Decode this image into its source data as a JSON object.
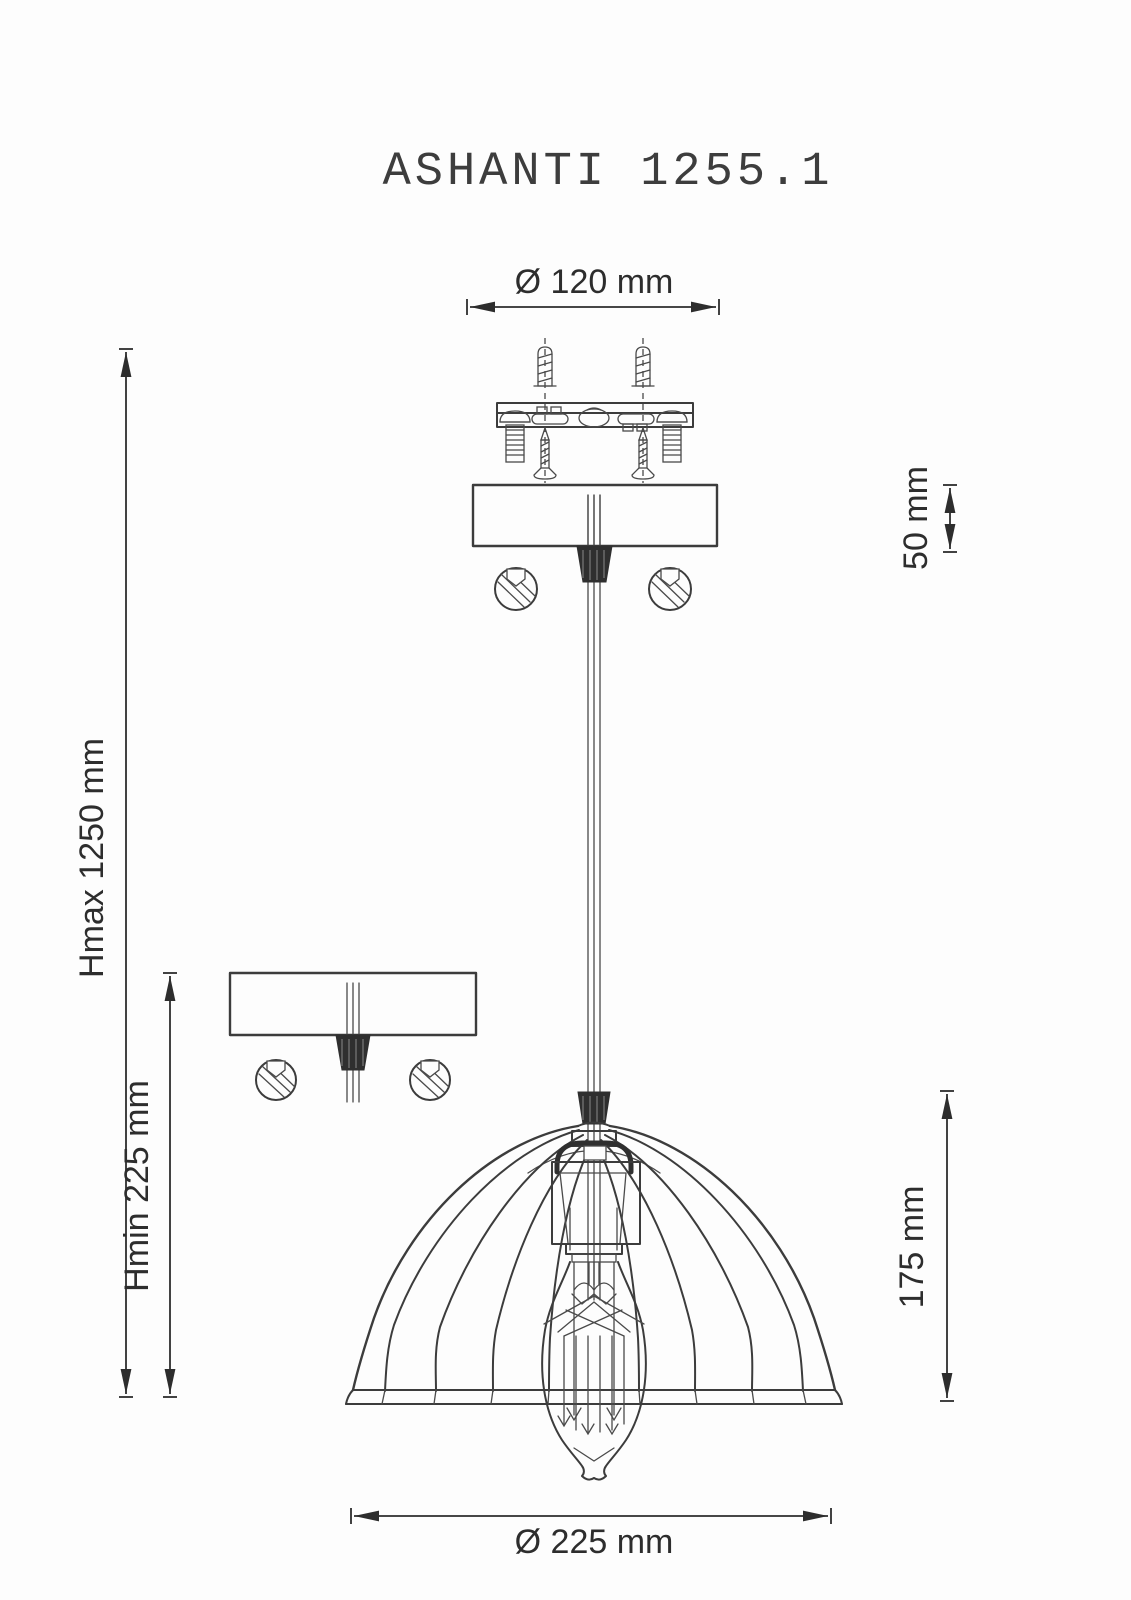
{
  "title": "ASHANTI 1255.1",
  "dimensions": {
    "mount_diameter": "Ø 120 mm",
    "canopy_height": "50 mm",
    "max_height": "Hmax 1250 mm",
    "min_height": "Hmin 225 mm",
    "shade_height": "175 mm",
    "shade_diameter": "Ø 225 mm"
  },
  "colors": {
    "line": "#3c3c3c",
    "dimension_text": "#2d2d2d",
    "background": "#fdfdfd",
    "solid_fill": "#2f2f2f"
  }
}
